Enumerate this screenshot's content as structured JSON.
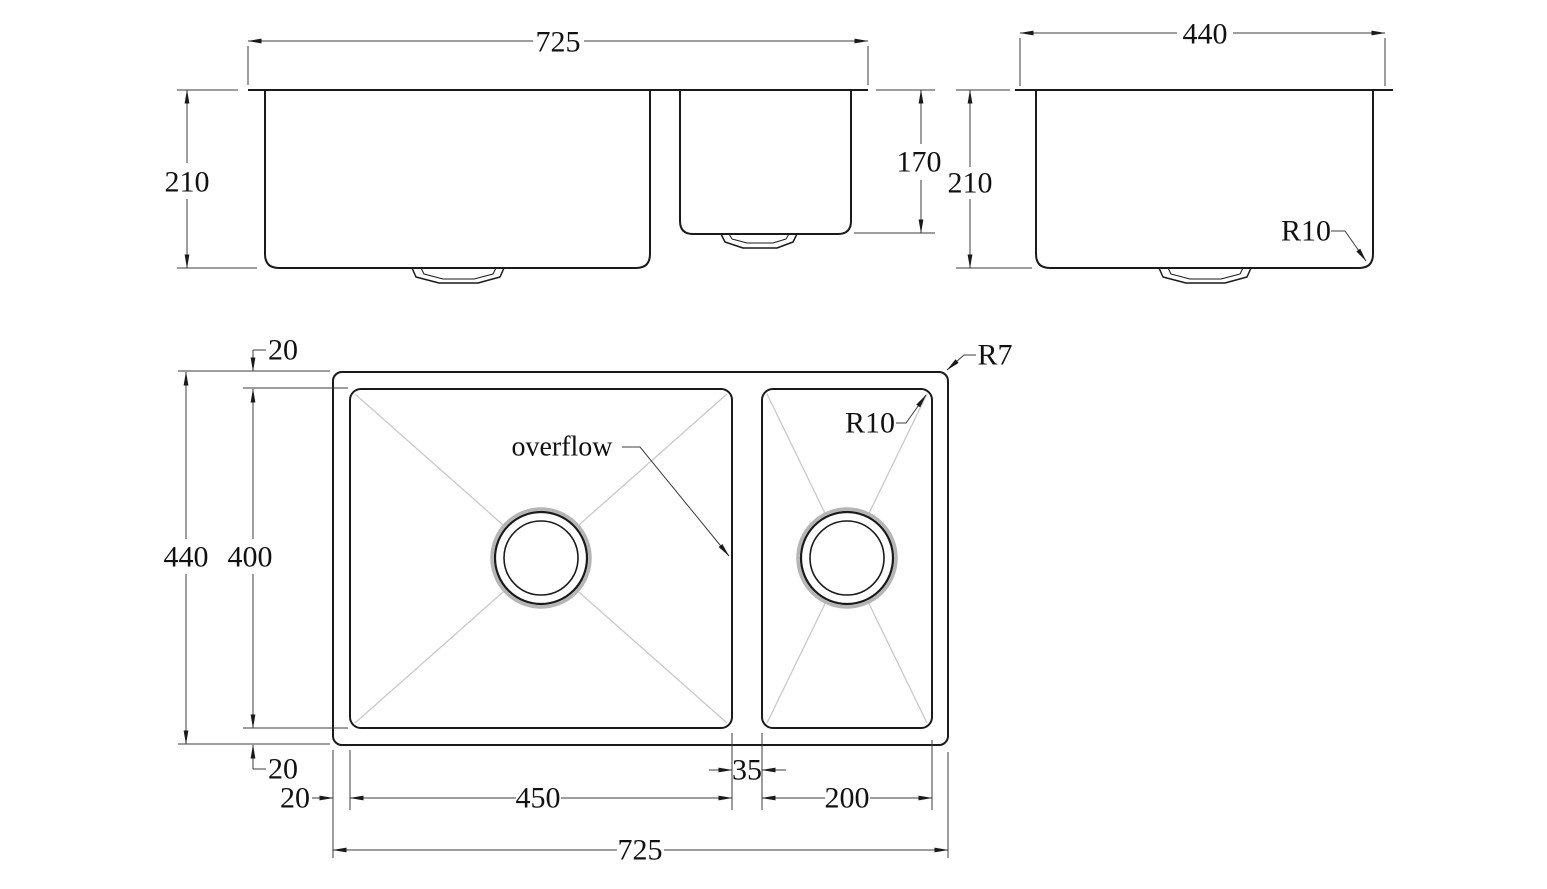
{
  "front": {
    "width": "725",
    "depth": "210",
    "small_bowl_depth": "170"
  },
  "side": {
    "width": "440",
    "depth": "210",
    "corner_radius": "R10"
  },
  "plan": {
    "overall_width": "725",
    "overall_depth": "440",
    "bowl_depth": "400",
    "main_bowl_width": "450",
    "divider_width": "35",
    "small_bowl_width": "200",
    "rim_top": "20",
    "rim_bottom": "20",
    "rim_left": "20",
    "overflow_label": "overflow",
    "outer_corner_radius": "R7",
    "bowl_corner_radius": "R10"
  },
  "colors": {
    "background": "#ffffff",
    "object_line": "#1a1a1a",
    "dimension_line": "#3c3c3c",
    "diagonal_line": "#c9c9c9"
  }
}
